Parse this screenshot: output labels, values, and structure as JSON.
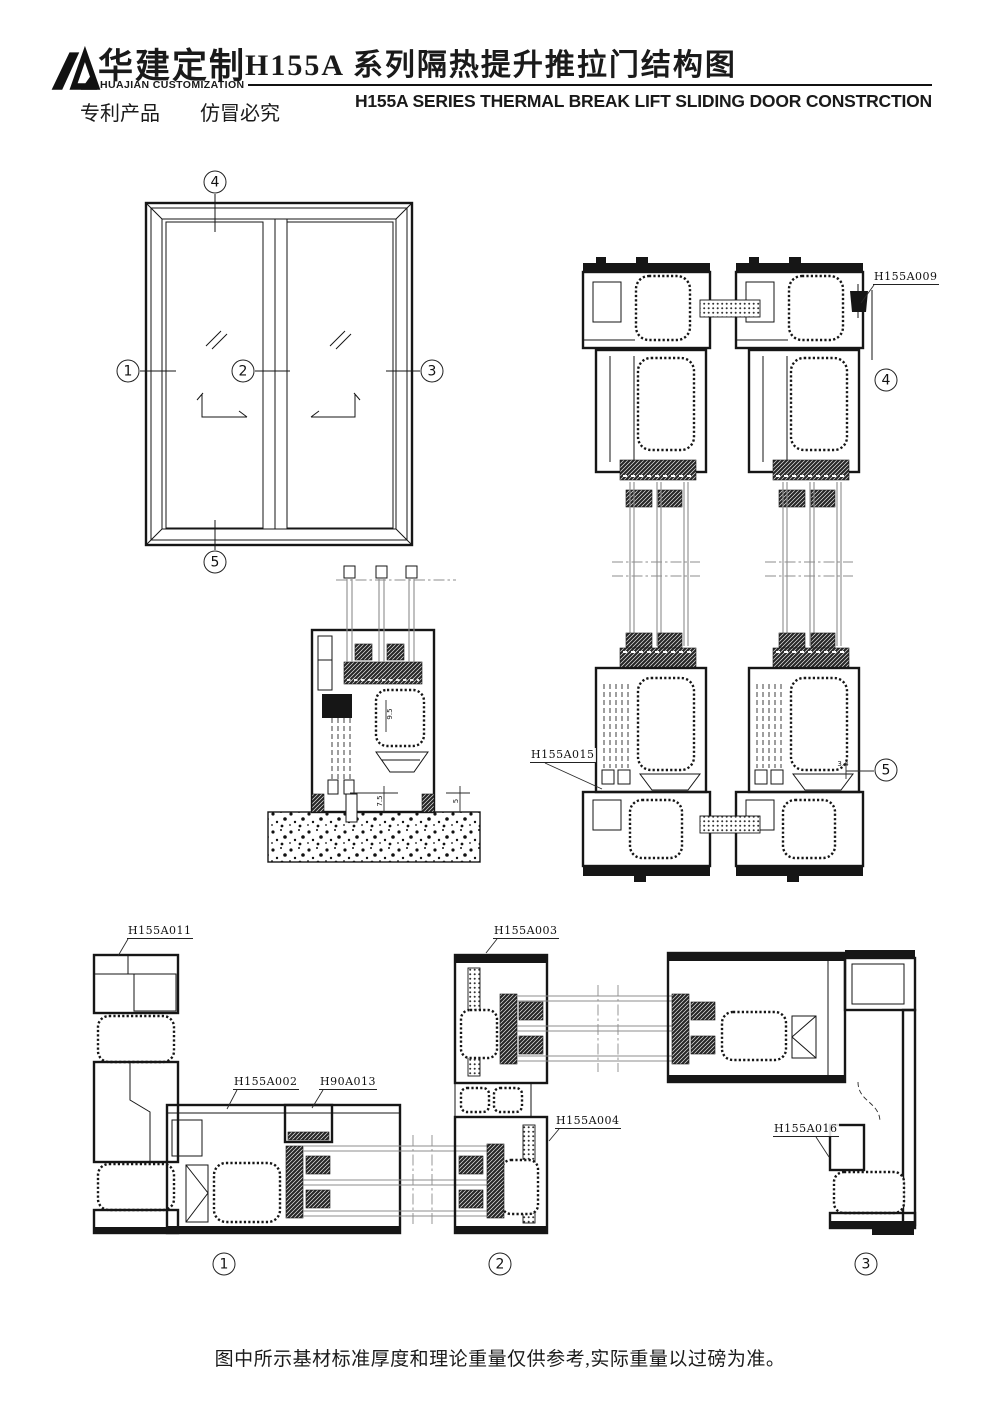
{
  "header": {
    "brand_cn": "华建定制",
    "brand_en": "HUAJIAN CUSTOMIZATION",
    "patent_notice": "专利产品　　仿冒必究",
    "title_cn": "H155A 系列隔热提升推拉门结构图",
    "title_en": "H155A SERIES THERMAL BREAK LIFT SLIDING DOOR CONSTRCTION"
  },
  "markers": {
    "elevation": {
      "top": "4",
      "left": "1",
      "center": "2",
      "right": "3",
      "bottom": "5"
    },
    "vertical_section": {
      "head": "4",
      "sill": "5"
    },
    "horizontal_section": {
      "left": "1",
      "center": "2",
      "right": "3"
    }
  },
  "callouts": {
    "h155a009": "H155A009",
    "h155a015": "H155A015",
    "h155a011": "H155A011",
    "h155a002": "H155A002",
    "h90a013": "H90A013",
    "h155a003": "H155A003",
    "h155a004": "H155A004",
    "h155a016": "H155A016"
  },
  "dimensions": {
    "sill_inner_height": "9.5",
    "sill_clearance": "7.5",
    "sill_edge": "5",
    "bottom_gap": "3.4"
  },
  "footer_note": "图中所示基材标准厚度和理论重量仅供参考,实际重量以过磅为准。",
  "colors": {
    "ink": "#1a1a1a",
    "glass_line": "#8c8c8c"
  }
}
